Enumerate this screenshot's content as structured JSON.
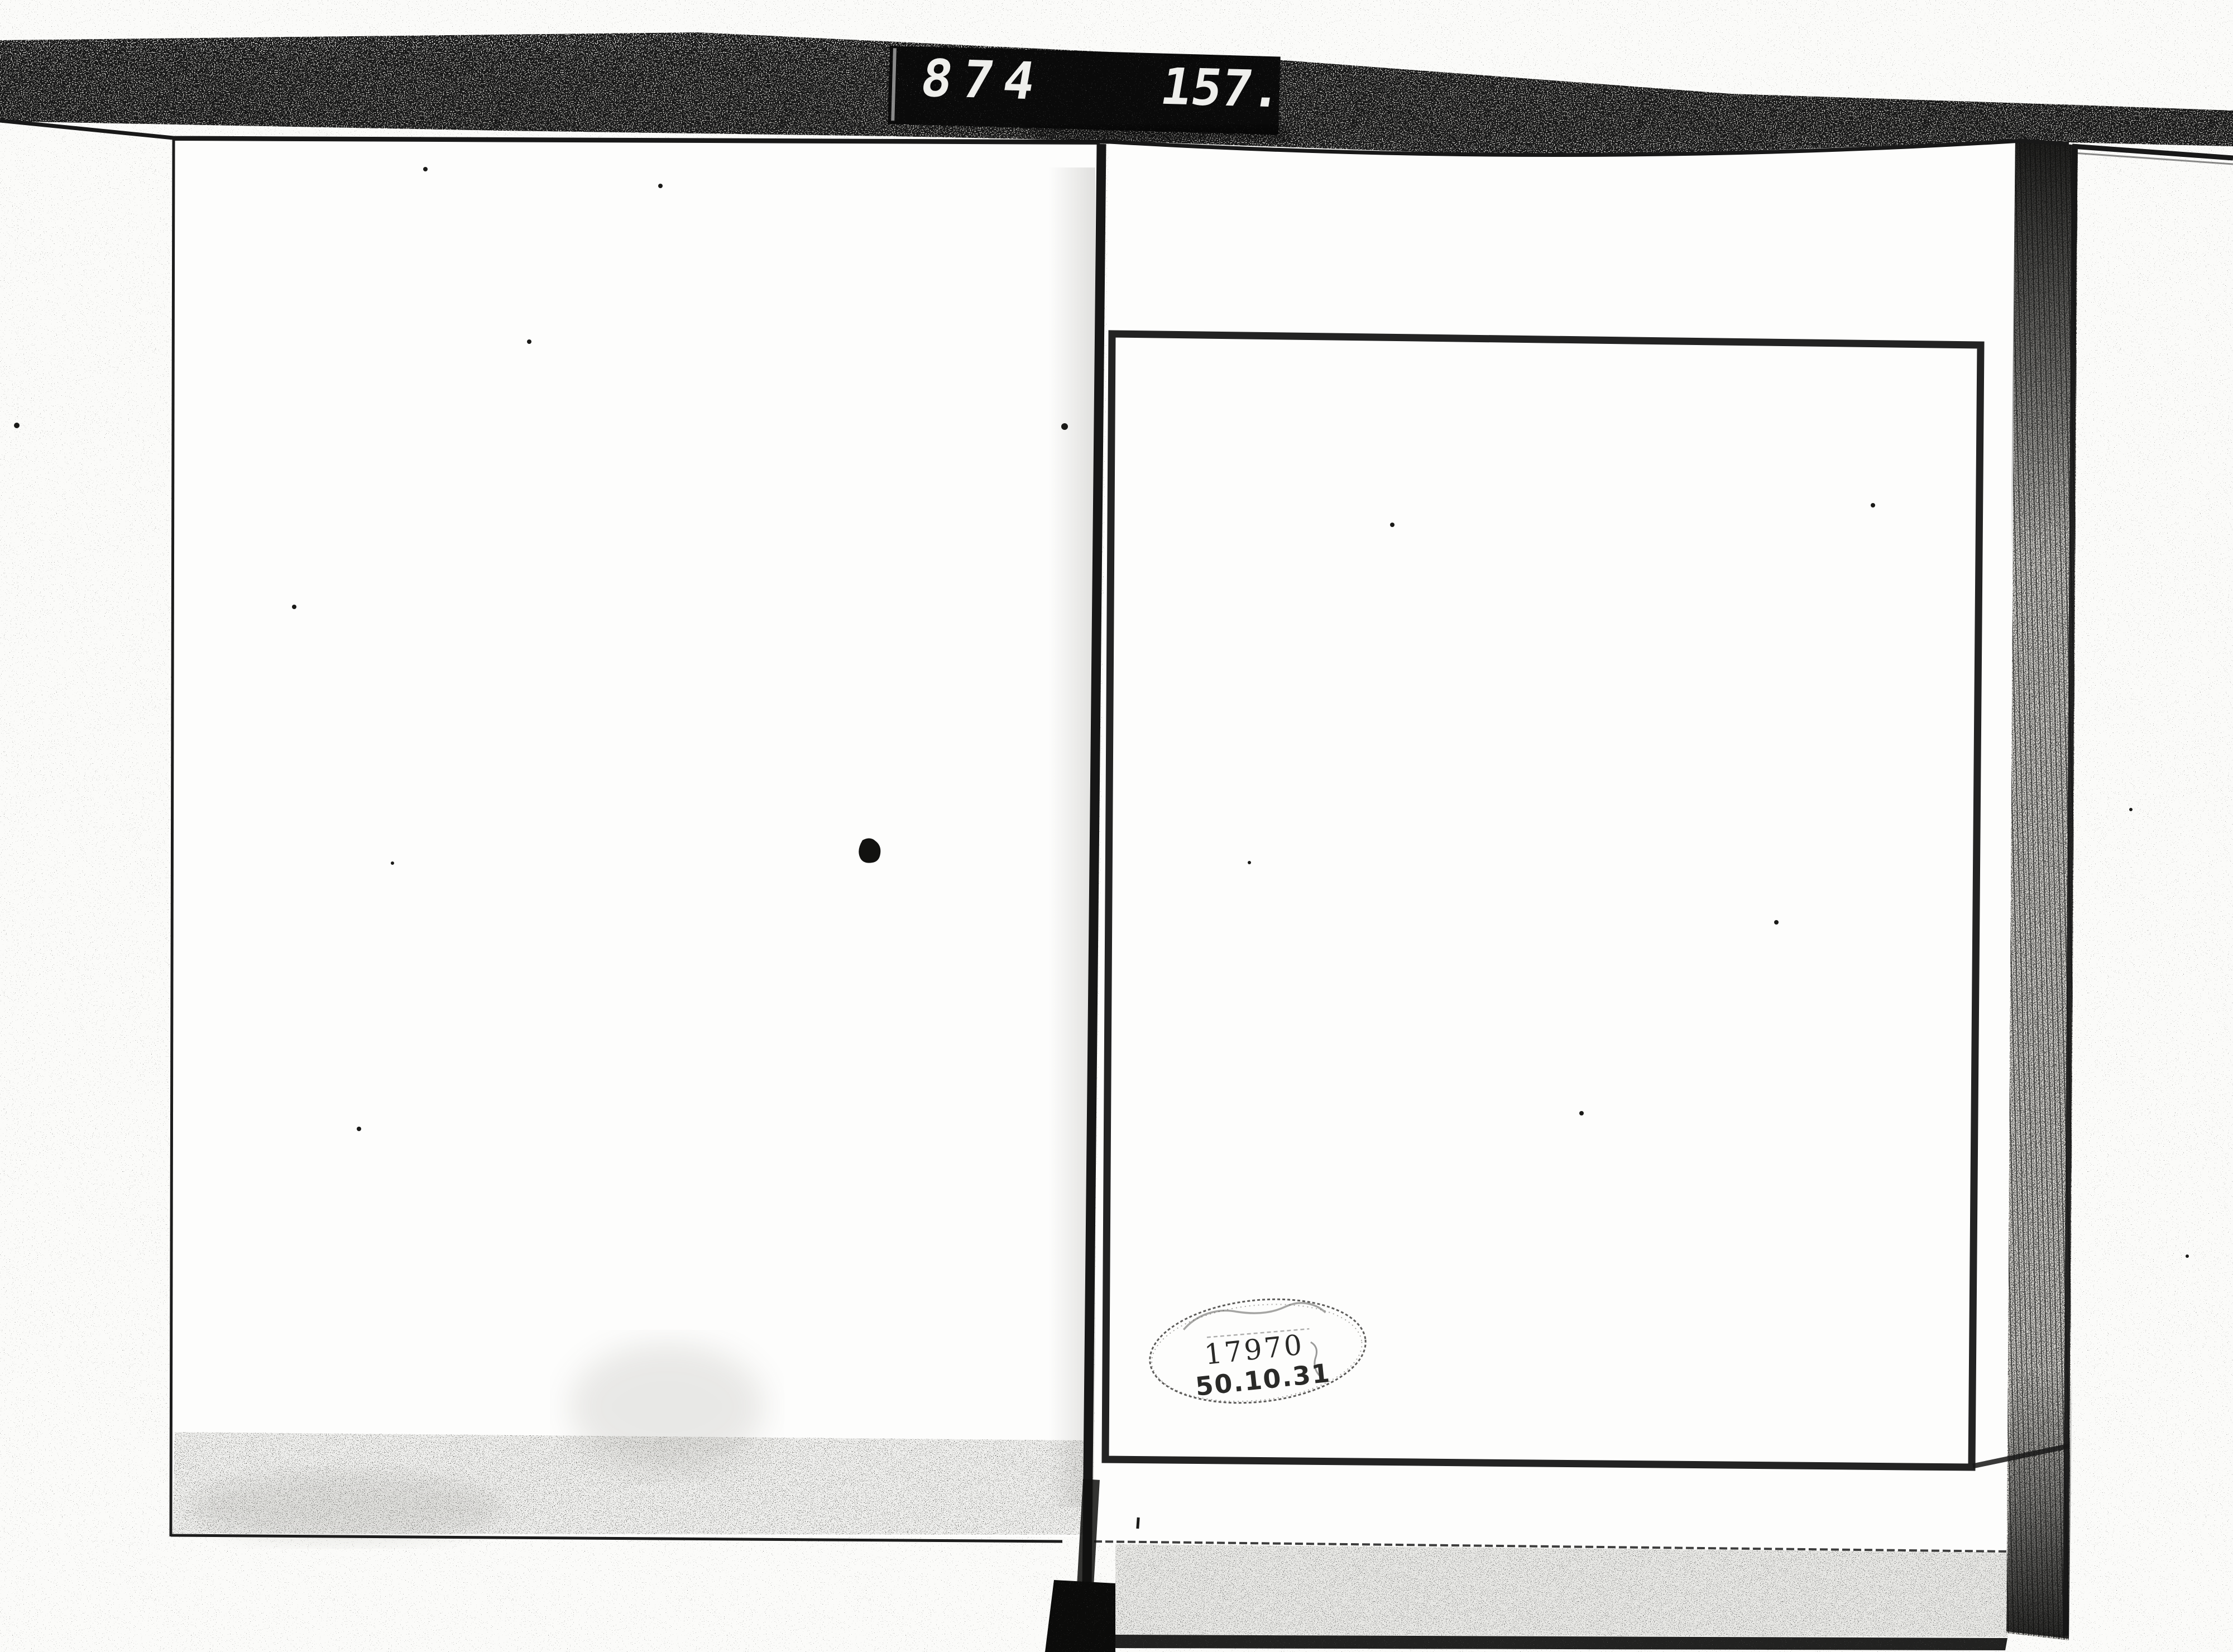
{
  "counter": {
    "reel_value": "874",
    "frame_value": "157."
  },
  "stamp": {
    "accession_number": "17970",
    "date_code": "50.10.31"
  },
  "colors": {
    "paper": "#fbfbf9",
    "page": "#fdfdfc",
    "ink": "#1c1c1c",
    "counter_background": "#0a0a0a",
    "counter_digit": "#efefec",
    "stamp_ink": "#2a2a28"
  }
}
